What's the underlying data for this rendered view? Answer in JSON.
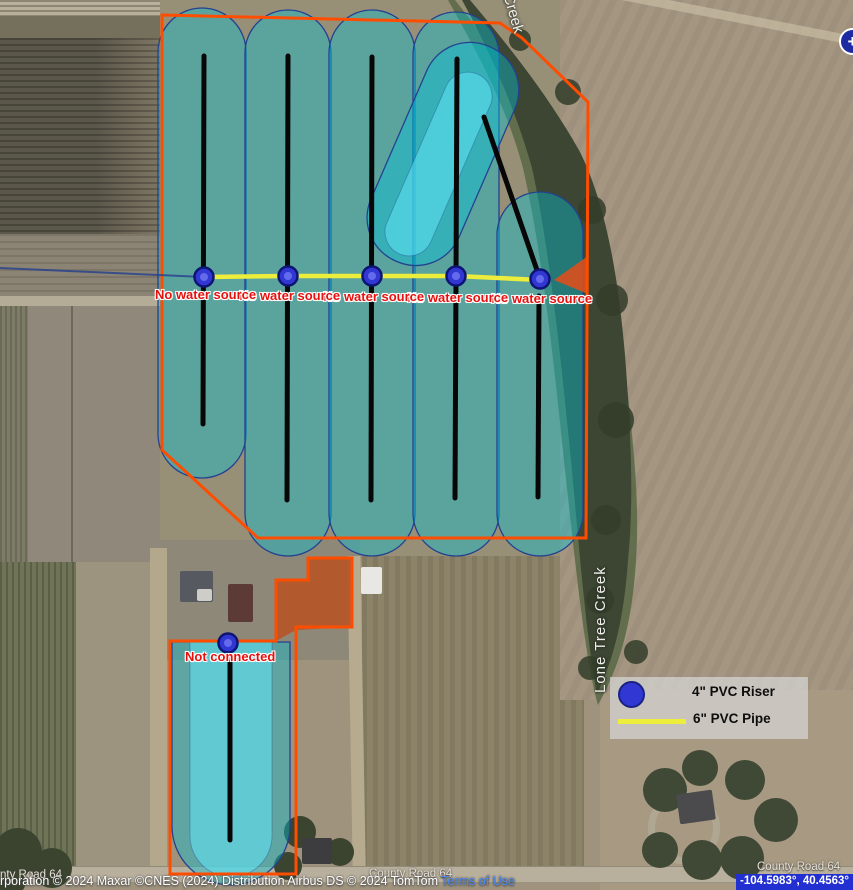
{
  "map": {
    "zoom_in_label": "+",
    "coordinates": "-104.5983°, 40.4563°"
  },
  "legend": {
    "items": [
      {
        "symbol": "riser-circle-icon",
        "label": "4\" PVC Riser"
      },
      {
        "symbol": "pipe-line-icon",
        "label": "6\" PVC Pipe"
      }
    ]
  },
  "overlay_labels": {
    "no_water": [
      "No water source",
      "No water source",
      "No water source",
      "No water source",
      "No water source"
    ],
    "not_connected": "Not connected"
  },
  "place_labels": {
    "creek_top": "Creek",
    "creek_right": "Lone Tree Creek",
    "roads": [
      "nty Road 64",
      "County Road 64",
      "County Road 64"
    ]
  },
  "attribution": {
    "text": "rporation © 2024 Maxar ©CNES (2024) Distribution Airbus DS © 2024 TomTom ",
    "terms": "Terms of Use"
  },
  "colors": {
    "boundary_orange": "#ff4d00",
    "pipe_yellow": "#eded3c",
    "riser_blue": "#3137d3",
    "irrigated_cyan": "#00c4da",
    "label_red": "#e8100c",
    "brown_field": "#b4572a",
    "coord_box_blue": "#2230d2",
    "zoom_button_blue": "#1d2ba3"
  }
}
